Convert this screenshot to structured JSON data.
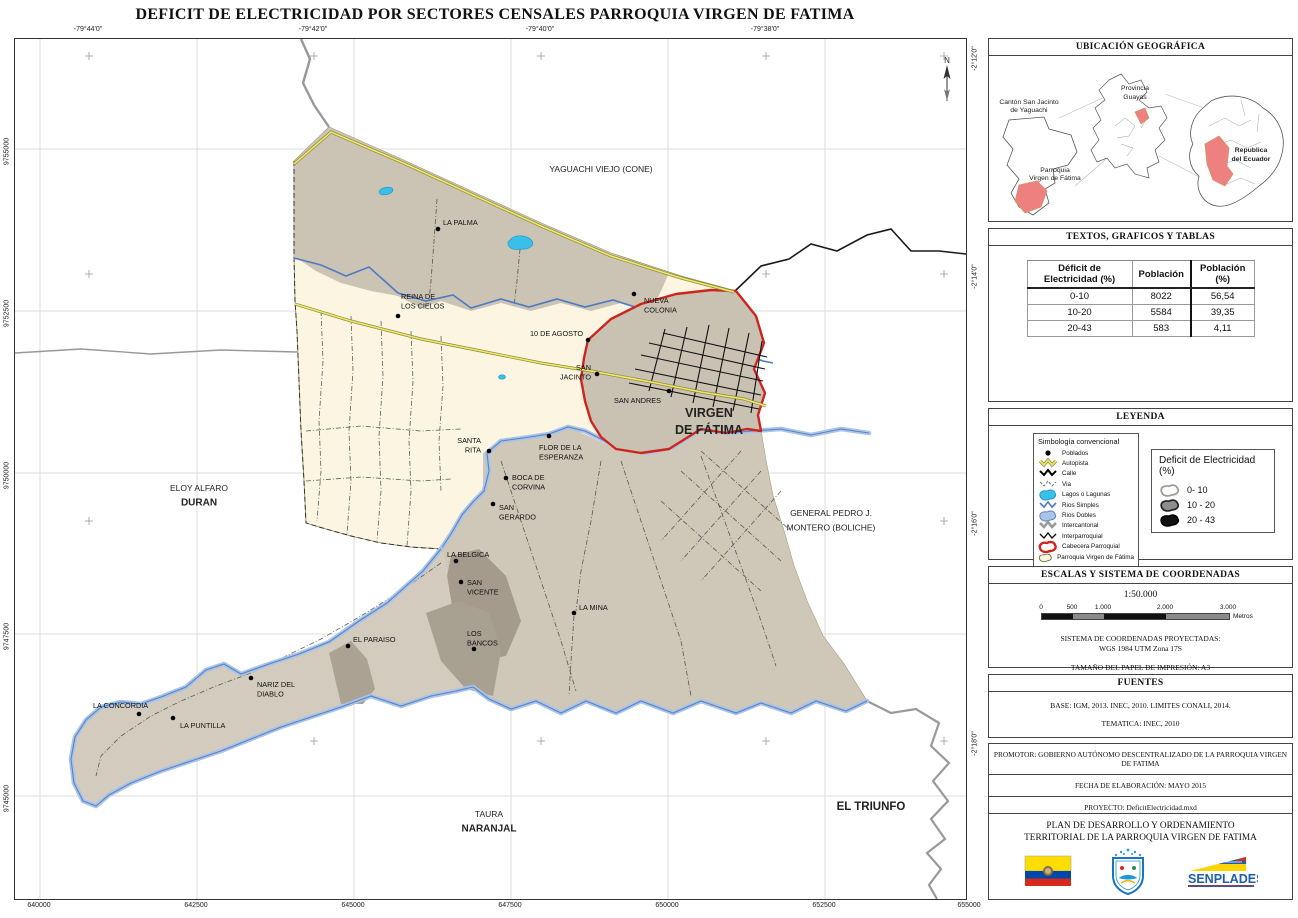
{
  "title": "DEFICIT DE ELECTRICIDAD POR SECTORES CENSALES PARROQUIA VIRGEN DE FATIMA",
  "map": {
    "north_label": "N",
    "axes": {
      "top": [
        {
          "t": "-79°44'0\"",
          "x": 74
        },
        {
          "t": "-79°42'0\"",
          "x": 299
        },
        {
          "t": "-79°40'0\"",
          "x": 526
        },
        {
          "t": "-79°38'0\"",
          "x": 751
        }
      ],
      "bottom": [
        {
          "t": "640000",
          "x": 25
        },
        {
          "t": "642500",
          "x": 182
        },
        {
          "t": "645000",
          "x": 339
        },
        {
          "t": "647500",
          "x": 496
        },
        {
          "t": "650000",
          "x": 653
        },
        {
          "t": "652500",
          "x": 810
        },
        {
          "t": "655000",
          "x": 955
        }
      ],
      "left": [
        {
          "t": "9755000",
          "y": 110
        },
        {
          "t": "9752500",
          "y": 272
        },
        {
          "t": "9750000",
          "y": 434
        },
        {
          "t": "9747500",
          "y": 595
        },
        {
          "t": "9745000",
          "y": 757
        }
      ],
      "right": [
        {
          "t": "-2°12'0\"",
          "y": 17
        },
        {
          "t": "-2°14'0\"",
          "y": 235
        },
        {
          "t": "-2°16'0\"",
          "y": 482
        },
        {
          "t": "-2°18'0\"",
          "y": 702
        }
      ]
    },
    "towns": [
      {
        "name": [
          "LA PALMA"
        ],
        "dot": [
          423,
          190
        ],
        "lx": 428,
        "ly": 186,
        "anchor": "start"
      },
      {
        "name": [
          "REINA DE",
          "LOS CIELOS"
        ],
        "dot": [
          383,
          277
        ],
        "lx": 386,
        "ly": 260,
        "anchor": "start"
      },
      {
        "name": [
          "NUEVA",
          "COLONIA"
        ],
        "dot": [
          619,
          255
        ],
        "lx": 629,
        "ly": 264,
        "anchor": "start"
      },
      {
        "name": [
          "10 DE AGOSTO"
        ],
        "dot": [
          573,
          301
        ],
        "lx": 568,
        "ly": 297,
        "anchor": "end"
      },
      {
        "name": [
          "SAN",
          "JACINTO"
        ],
        "dot": [
          582,
          335
        ],
        "lx": 576,
        "ly": 331,
        "anchor": "end"
      },
      {
        "name": [
          "SAN ANDRES"
        ],
        "dot": [
          654,
          352
        ],
        "lx": 646,
        "ly": 364,
        "anchor": "end"
      },
      {
        "name": [
          "SANTA",
          "RITA"
        ],
        "dot": [
          474,
          412
        ],
        "lx": 466,
        "ly": 404,
        "anchor": "end"
      },
      {
        "name": [
          "FLOR DE LA",
          "ESPERANZA"
        ],
        "dot": [
          534,
          397
        ],
        "lx": 524,
        "ly": 411,
        "anchor": "start"
      },
      {
        "name": [
          "BOCA DE",
          "CORVINA"
        ],
        "dot": [
          491,
          439
        ],
        "lx": 497,
        "ly": 441,
        "anchor": "start"
      },
      {
        "name": [
          "SAN",
          "GERARDO"
        ],
        "dot": [
          478,
          465
        ],
        "lx": 484,
        "ly": 471,
        "anchor": "start"
      },
      {
        "name": [
          "LA BELGICA"
        ],
        "dot": [
          441,
          522
        ],
        "lx": 432,
        "ly": 518,
        "anchor": "start"
      },
      {
        "name": [
          "SAN",
          "VICENTE"
        ],
        "dot": [
          446,
          543
        ],
        "lx": 452,
        "ly": 546,
        "anchor": "start"
      },
      {
        "name": [
          "LA MINA"
        ],
        "dot": [
          559,
          574
        ],
        "lx": 564,
        "ly": 571,
        "anchor": "start"
      },
      {
        "name": [
          "EL PARAISO"
        ],
        "dot": [
          333,
          607
        ],
        "lx": 338,
        "ly": 603,
        "anchor": "start"
      },
      {
        "name": [
          "LOS",
          "BANCOS"
        ],
        "dot": [
          459,
          610
        ],
        "lx": 452,
        "ly": 597,
        "anchor": "start"
      },
      {
        "name": [
          "NARIZ DEL",
          "DIABLO"
        ],
        "dot": [
          236,
          639
        ],
        "lx": 242,
        "ly": 648,
        "anchor": "start"
      },
      {
        "name": [
          "LA CONCORDIA"
        ],
        "dot": [
          124,
          675
        ],
        "lx": 78,
        "ly": 669,
        "anchor": "start"
      },
      {
        "name": [
          "LA PUNTILLA"
        ],
        "dot": [
          158,
          679
        ],
        "lx": 165,
        "ly": 689,
        "anchor": "start"
      }
    ],
    "areas": [
      {
        "lines": [
          {
            "t": "YAGUACHI VIEJO (CONE)",
            "b": false
          }
        ],
        "x": 586,
        "y": 133,
        "size": 8.5
      },
      {
        "lines": [
          {
            "t": "ELOY ALFARO",
            "b": false
          },
          {
            "t": "DURAN",
            "b": true
          }
        ],
        "x": 184,
        "y": 452,
        "size": 8.5
      },
      {
        "lines": [
          {
            "t": "GENERAL PEDRO J.",
            "b": false
          },
          {
            "t": "MONTERO (BOLICHE)",
            "b": false
          }
        ],
        "x": 816,
        "y": 477,
        "size": 8.5
      },
      {
        "lines": [
          {
            "t": "TAURA",
            "b": false
          },
          {
            "t": "NARANJAL",
            "b": true
          }
        ],
        "x": 474,
        "y": 778,
        "size": 8.5
      },
      {
        "lines": [
          {
            "t": "EL TRIUNFO",
            "b": true
          }
        ],
        "x": 856,
        "y": 771,
        "size": 10
      },
      {
        "lines": [
          {
            "t": "VIRGEN",
            "b": true
          },
          {
            "t": "DE FÁTIMA",
            "b": true
          }
        ],
        "x": 694,
        "y": 378,
        "size": 11
      }
    ]
  },
  "sidebar": {
    "panel1": {
      "title": "UBICACIÓN GEOGRÁFICA",
      "canton_l1": "Cantón San Jacinto",
      "canton_l2": "de Yaguachi",
      "parroquia_l1": "Parroquia",
      "parroquia_l2": "Virgen  de Fátima",
      "provincia_l1": "Provincia",
      "provincia_l2": "Guayas",
      "ecuador_l1": "Republica",
      "ecuador_l2": "del Ecuador"
    },
    "panel2": {
      "title": "TEXTOS, GRAFICOS Y TABLAS",
      "table": {
        "headers": [
          "Déficit de Electricidad (%)",
          "Población",
          "Población  (%)"
        ],
        "rows": [
          [
            "0-10",
            "8022",
            "56,54"
          ],
          [
            "10-20",
            "5584",
            "39,35"
          ],
          [
            "20-43",
            "583",
            "4,11"
          ]
        ]
      }
    },
    "panel3": {
      "title": "LEYENDA",
      "symbology": {
        "title": "Simbología convencional",
        "items": [
          {
            "label": "Poblados",
            "icon": "dot"
          },
          {
            "label": "Autopista",
            "icon": "line-autopista"
          },
          {
            "label": "Calle",
            "icon": "line-calle"
          },
          {
            "label": "Via",
            "icon": "line-via"
          },
          {
            "label": "Lagos o Lagunas",
            "icon": "poly-lago"
          },
          {
            "label": "Rios Simples",
            "icon": "line-rio"
          },
          {
            "label": "Rios Dobles",
            "icon": "poly-riodoble"
          },
          {
            "label": "Intercantonal",
            "icon": "line-intercantonal"
          },
          {
            "label": "Interparroquial",
            "icon": "line-interparroquial"
          },
          {
            "label": "Cabecera Parroquial",
            "icon": "poly-cabecera"
          },
          {
            "label": "Parroquia Virgen de Fátima",
            "icon": "poly-parroquia"
          }
        ]
      },
      "deficit": {
        "title": "Deficit de Electricidad (%)",
        "items": [
          {
            "label": "0- 10",
            "fill": "#FDFDF5",
            "stroke": "#9a9a9a"
          },
          {
            "label": "10 - 20",
            "fill": "#8E8E8E",
            "stroke": "#222"
          },
          {
            "label": "20 - 43",
            "fill": "#111111",
            "stroke": "#000"
          }
        ]
      }
    },
    "panel4": {
      "title": "ESCALAS Y SISTEMA DE COORDENADAS",
      "scale": "1:50.000",
      "bar_labels": [
        "0",
        "500",
        "1.000",
        "2.000",
        "3.000"
      ],
      "unit": "Metros",
      "crs_line1": "SISTEMA DE COORDENADAS PROYECTADAS:",
      "crs_line2": "WGS 1984 UTM Zona 17S",
      "paper": "TAMAÑO DEL PAPEL DE IMPRESIÓN: A3"
    },
    "panel5": {
      "title": "FUENTES",
      "base": "BASE:   IGM, 2013. INEC, 2010. LIMITES CONALI, 2014.",
      "tematica": "TEMATICA:  INEC, 2010"
    },
    "panel6": {
      "rows": [
        "PROMOTOR:   GOBIERNO AUTÓNOMO DESCENTRALIZADO DE LA PARROQUIA VIRGEN DE FATIMA",
        "FECHA DE ELABORACIÓN:   MAYO 2015",
        "PROYECTO:  DeficitElectricidad.mxd"
      ]
    },
    "panel7": {
      "title_line1": "PLAN DE DESARROLLO Y ORDENAMIENTO",
      "title_line2": "TERRITORIAL DE LA PARROQUIA VIRGEN DE FATIMA",
      "senplades": "SENPLADES"
    }
  },
  "colors": {
    "deficit_0_10": "#FBF5E2",
    "deficit_10_20": "#CBC3B3",
    "deficit_20_43": "#A49B8C",
    "cabecera_red": "#CE241E",
    "autopista_yellow": "#EFE96B",
    "rio_blue": "#4E79C5",
    "rio_doble": "#A9C4E6",
    "lago_cyan": "#39BFE8",
    "intercantonal_gray": "#999999",
    "inset_red": "#EE8080"
  }
}
